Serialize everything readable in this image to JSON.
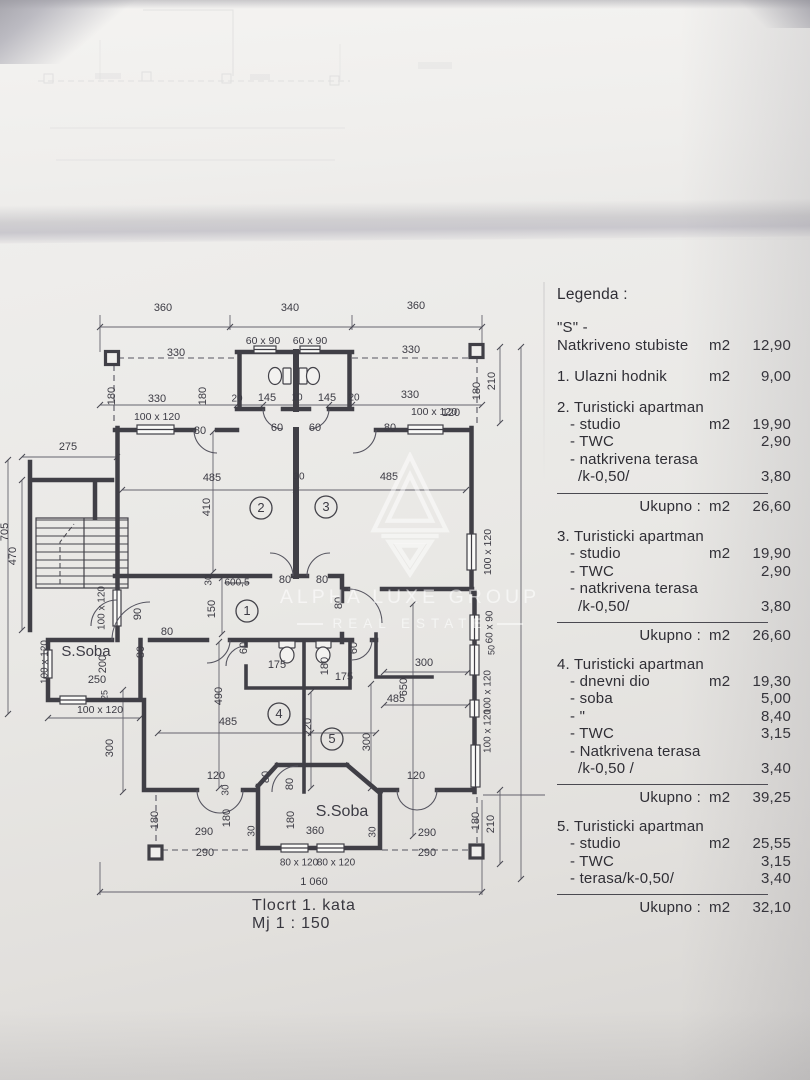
{
  "document": {
    "title": "Tlocrt 1. kata",
    "scale": "Mj 1 : 150"
  },
  "watermark": {
    "wordmark": "ALPHA LUXE GROUP",
    "tagline": "REAL ESTATE"
  },
  "legend": {
    "rows": [
      {
        "type": "title",
        "label": "Legenda :"
      },
      {
        "type": "line",
        "label": "\"S\" -",
        "mt": 16
      },
      {
        "type": "line",
        "label": "Natkriveno stubiste",
        "unit": "m2",
        "value": "12,90"
      },
      {
        "type": "line",
        "label": "1. Ulazni hodnik",
        "unit": "m2",
        "value": "9,00",
        "mt": 14
      },
      {
        "type": "line",
        "label": "2. Turisticki apartman",
        "mt": 13
      },
      {
        "type": "sub",
        "label": "- studio",
        "unit": "m2",
        "value": "19,90"
      },
      {
        "type": "sub",
        "label": "- TWC",
        "value": "2,90"
      },
      {
        "type": "sub",
        "label": "- natkrivena terasa"
      },
      {
        "type": "sub2",
        "label": "/k-0,50/",
        "value": "3,80"
      },
      {
        "type": "total",
        "label": "Ukupno :",
        "unit": "m2",
        "value": "26,60"
      },
      {
        "type": "line",
        "label": "3. Turisticki apartman",
        "mt": 13
      },
      {
        "type": "sub",
        "label": "- studio",
        "unit": "m2",
        "value": "19,90"
      },
      {
        "type": "sub",
        "label": "- TWC",
        "value": "2,90"
      },
      {
        "type": "sub",
        "label": "- natkrivena terasa"
      },
      {
        "type": "sub2",
        "label": "/k-0,50/",
        "value": "3,80"
      },
      {
        "type": "total",
        "label": "Ukupno :",
        "unit": "m2",
        "value": "26,60"
      },
      {
        "type": "line",
        "label": "4. Turisticki apartman",
        "mt": 11
      },
      {
        "type": "sub",
        "label": "- dnevni dio",
        "unit": "m2",
        "value": "19,30"
      },
      {
        "type": "sub",
        "label": "- soba",
        "value": "5,00"
      },
      {
        "type": "sub",
        "label": "- \"",
        "value": "8,40"
      },
      {
        "type": "sub",
        "label": "- TWC",
        "value": "3,15"
      },
      {
        "type": "sub",
        "label": "- Natkrivena terasa"
      },
      {
        "type": "sub2",
        "label": "/k-0,50 /",
        "value": "3,40"
      },
      {
        "type": "total",
        "label": "Ukupno :",
        "unit": "m2",
        "value": "39,25"
      },
      {
        "type": "line",
        "label": "5. Turisticki apartman",
        "mt": 11
      },
      {
        "type": "sub",
        "label": "- studio",
        "unit": "m2",
        "value": "25,55"
      },
      {
        "type": "sub",
        "label": "- TWC",
        "value": "3,15"
      },
      {
        "type": "sub",
        "label": "- terasa/k-0,50/",
        "value": "3,40"
      },
      {
        "type": "total",
        "label": "Ukupno :",
        "unit": "m2",
        "value": "32,10"
      }
    ]
  },
  "plan": {
    "rooms": [
      {
        "n": "1",
        "x": 247,
        "y": 611
      },
      {
        "n": "2",
        "x": 261,
        "y": 508
      },
      {
        "n": "3",
        "x": 326,
        "y": 507
      },
      {
        "n": "4",
        "x": 279,
        "y": 714
      },
      {
        "n": "5",
        "x": 332,
        "y": 739
      }
    ],
    "labels": [
      {
        "t": "360",
        "x": 163,
        "y": 308
      },
      {
        "t": "340",
        "x": 290,
        "y": 308
      },
      {
        "t": "360",
        "x": 416,
        "y": 306
      },
      {
        "t": "60 x 90",
        "x": 263,
        "y": 341,
        "s": 10.5
      },
      {
        "t": "60 x 90",
        "x": 310,
        "y": 341,
        "s": 10.5
      },
      {
        "t": "330",
        "x": 176,
        "y": 353
      },
      {
        "t": "330",
        "x": 411,
        "y": 350
      },
      {
        "t": "180",
        "x": 112,
        "y": 396,
        "r": -90
      },
      {
        "t": "180",
        "x": 203,
        "y": 396,
        "r": -90
      },
      {
        "t": "330",
        "x": 157,
        "y": 399
      },
      {
        "t": "20",
        "x": 237,
        "y": 399,
        "s": 10
      },
      {
        "t": "145",
        "x": 267,
        "y": 398
      },
      {
        "t": "10",
        "x": 297,
        "y": 398,
        "s": 10
      },
      {
        "t": "145",
        "x": 327,
        "y": 398
      },
      {
        "t": "20",
        "x": 354,
        "y": 398,
        "s": 10
      },
      {
        "t": "330",
        "x": 410,
        "y": 395
      },
      {
        "t": "180",
        "x": 477,
        "y": 391,
        "r": -90
      },
      {
        "t": "210",
        "x": 492,
        "y": 381,
        "r": -90
      },
      {
        "t": "100 x 120",
        "x": 157,
        "y": 417,
        "s": 10.5
      },
      {
        "t": "100 x 120",
        "x": 434,
        "y": 412,
        "s": 10.5
      },
      {
        "t": "80",
        "x": 200,
        "y": 431
      },
      {
        "t": "60",
        "x": 277,
        "y": 428
      },
      {
        "t": "60",
        "x": 315,
        "y": 428
      },
      {
        "t": "80",
        "x": 390,
        "y": 428
      },
      {
        "t": "485",
        "x": 212,
        "y": 478
      },
      {
        "t": "30",
        "x": 299,
        "y": 477,
        "s": 10
      },
      {
        "t": "485",
        "x": 389,
        "y": 477
      },
      {
        "t": "410",
        "x": 207,
        "y": 507,
        "r": -90
      },
      {
        "t": "100 x 120",
        "x": 488,
        "y": 552,
        "r": -90,
        "s": 10.5
      },
      {
        "t": "30",
        "x": 209,
        "y": 580,
        "r": -90,
        "s": 10
      },
      {
        "t": "600,5",
        "x": 237,
        "y": 583,
        "s": 10,
        "strike": true
      },
      {
        "t": "80",
        "x": 285,
        "y": 580
      },
      {
        "t": "80",
        "x": 322,
        "y": 580
      },
      {
        "t": "150",
        "x": 212,
        "y": 609,
        "r": -90
      },
      {
        "t": "90",
        "x": 138,
        "y": 614,
        "r": -90
      },
      {
        "t": "80",
        "x": 167,
        "y": 632
      },
      {
        "t": "80",
        "x": 141,
        "y": 652,
        "r": -90
      },
      {
        "t": "80",
        "x": 339,
        "y": 603,
        "r": -90
      },
      {
        "t": "60",
        "x": 244,
        "y": 648,
        "r": -90
      },
      {
        "t": "60",
        "x": 354,
        "y": 648,
        "r": -90
      },
      {
        "t": "175",
        "x": 277,
        "y": 665
      },
      {
        "t": "180",
        "x": 325,
        "y": 666,
        "r": -90
      },
      {
        "t": "175",
        "x": 344,
        "y": 677
      },
      {
        "t": "300",
        "x": 424,
        "y": 663
      },
      {
        "t": "650",
        "x": 404,
        "y": 687,
        "r": -90
      },
      {
        "t": "485",
        "x": 396,
        "y": 699
      },
      {
        "t": "300",
        "x": 367,
        "y": 742,
        "r": -90
      },
      {
        "t": "490",
        "x": 219,
        "y": 696,
        "r": -90
      },
      {
        "t": "485",
        "x": 228,
        "y": 722
      },
      {
        "t": "220",
        "x": 308,
        "y": 727,
        "r": -90
      },
      {
        "t": "S.Soba",
        "x": 86,
        "y": 652,
        "s": 15
      },
      {
        "t": "200",
        "x": 103,
        "y": 664,
        "r": -90
      },
      {
        "t": "250",
        "x": 97,
        "y": 680
      },
      {
        "t": "25",
        "x": 105,
        "y": 695,
        "r": -90,
        "s": 9
      },
      {
        "t": "100 x 120",
        "x": 45,
        "y": 662,
        "r": -90,
        "s": 10
      },
      {
        "t": "100 x 120",
        "x": 102,
        "y": 608,
        "r": -90,
        "s": 10
      },
      {
        "t": "100 x 120",
        "x": 100,
        "y": 710,
        "s": 10.5
      },
      {
        "t": "470",
        "x": 13,
        "y": 556,
        "r": -90
      },
      {
        "t": "705",
        "x": 5,
        "y": 532,
        "r": -90
      },
      {
        "t": "275",
        "x": 68,
        "y": 447
      },
      {
        "t": "300",
        "x": 110,
        "y": 748,
        "r": -90
      },
      {
        "t": "120",
        "x": 216,
        "y": 776
      },
      {
        "t": "120",
        "x": 416,
        "y": 776
      },
      {
        "t": "80",
        "x": 266,
        "y": 777,
        "r": -90
      },
      {
        "t": "80",
        "x": 290,
        "y": 784,
        "r": -90
      },
      {
        "t": "30",
        "x": 226,
        "y": 790,
        "r": -90,
        "s": 10
      },
      {
        "t": "180",
        "x": 155,
        "y": 820,
        "r": -90
      },
      {
        "t": "180",
        "x": 227,
        "y": 818,
        "r": -90
      },
      {
        "t": "180",
        "x": 291,
        "y": 820,
        "r": -90
      },
      {
        "t": "180",
        "x": 476,
        "y": 821,
        "r": -90
      },
      {
        "t": "210",
        "x": 491,
        "y": 824,
        "r": -90
      },
      {
        "t": "S.Soba",
        "x": 342,
        "y": 812,
        "s": 16
      },
      {
        "t": "290",
        "x": 204,
        "y": 832
      },
      {
        "t": "30",
        "x": 252,
        "y": 831,
        "r": -90,
        "s": 10
      },
      {
        "t": "360",
        "x": 315,
        "y": 831
      },
      {
        "t": "30",
        "x": 373,
        "y": 832,
        "r": -90,
        "s": 10
      },
      {
        "t": "290",
        "x": 427,
        "y": 833
      },
      {
        "t": "290",
        "x": 205,
        "y": 853
      },
      {
        "t": "290",
        "x": 427,
        "y": 853
      },
      {
        "t": "80 x 120",
        "x": 299,
        "y": 863,
        "s": 10
      },
      {
        "t": "80 x 120",
        "x": 336,
        "y": 863,
        "s": 10
      },
      {
        "t": "1 060",
        "x": 314,
        "y": 882
      },
      {
        "t": "100 x 120",
        "x": 488,
        "y": 692,
        "r": -90,
        "s": 10
      },
      {
        "t": "100 x 120",
        "x": 488,
        "y": 731,
        "r": -90,
        "s": 10
      },
      {
        "t": "60 x 90",
        "x": 490,
        "y": 627,
        "r": -90,
        "s": 10
      },
      {
        "t": "50",
        "x": 492,
        "y": 650,
        "r": -90,
        "s": 9
      },
      {
        "t": "120",
        "x": 451,
        "y": 413
      }
    ]
  }
}
